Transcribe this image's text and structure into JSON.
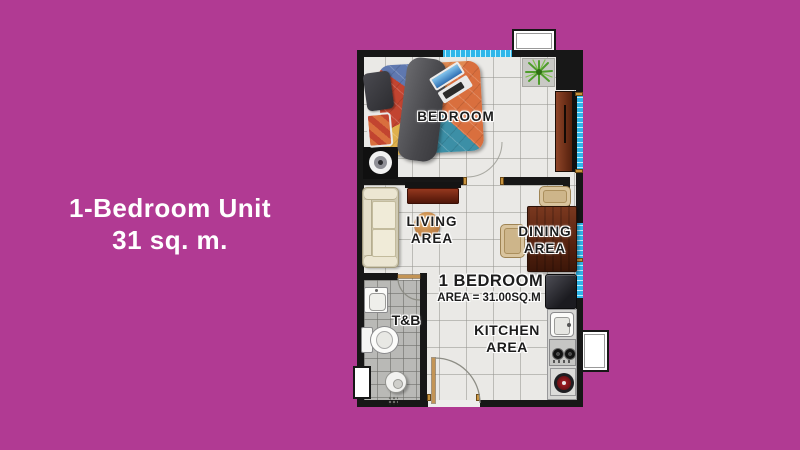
{
  "canvas": {
    "background": "#b13a93"
  },
  "headline": {
    "line1": "1-Bedroom Unit",
    "line2": "31 sq. m."
  },
  "floorplan": {
    "labels": {
      "bedroom": "BEDROOM",
      "living_line1": "LIVING",
      "living_line2": "AREA",
      "dining_line1": "DINING",
      "dining_line2": "AREA",
      "tb": "T&B",
      "kitchen_line1": "KITCHEN",
      "kitchen_line2": "AREA",
      "unit_line1": "1 BEDROOM",
      "unit_line2": "AREA = 31.00SQ.M"
    },
    "colors": {
      "background_magenta": "#b13a93",
      "wall": "#171717",
      "window_cyan": "#2fb6e9",
      "floor_tile": "#eae9e6",
      "tb_tile": "#b9b9b6",
      "wood": "#6a2210",
      "text_halo": "#ffffff"
    }
  }
}
